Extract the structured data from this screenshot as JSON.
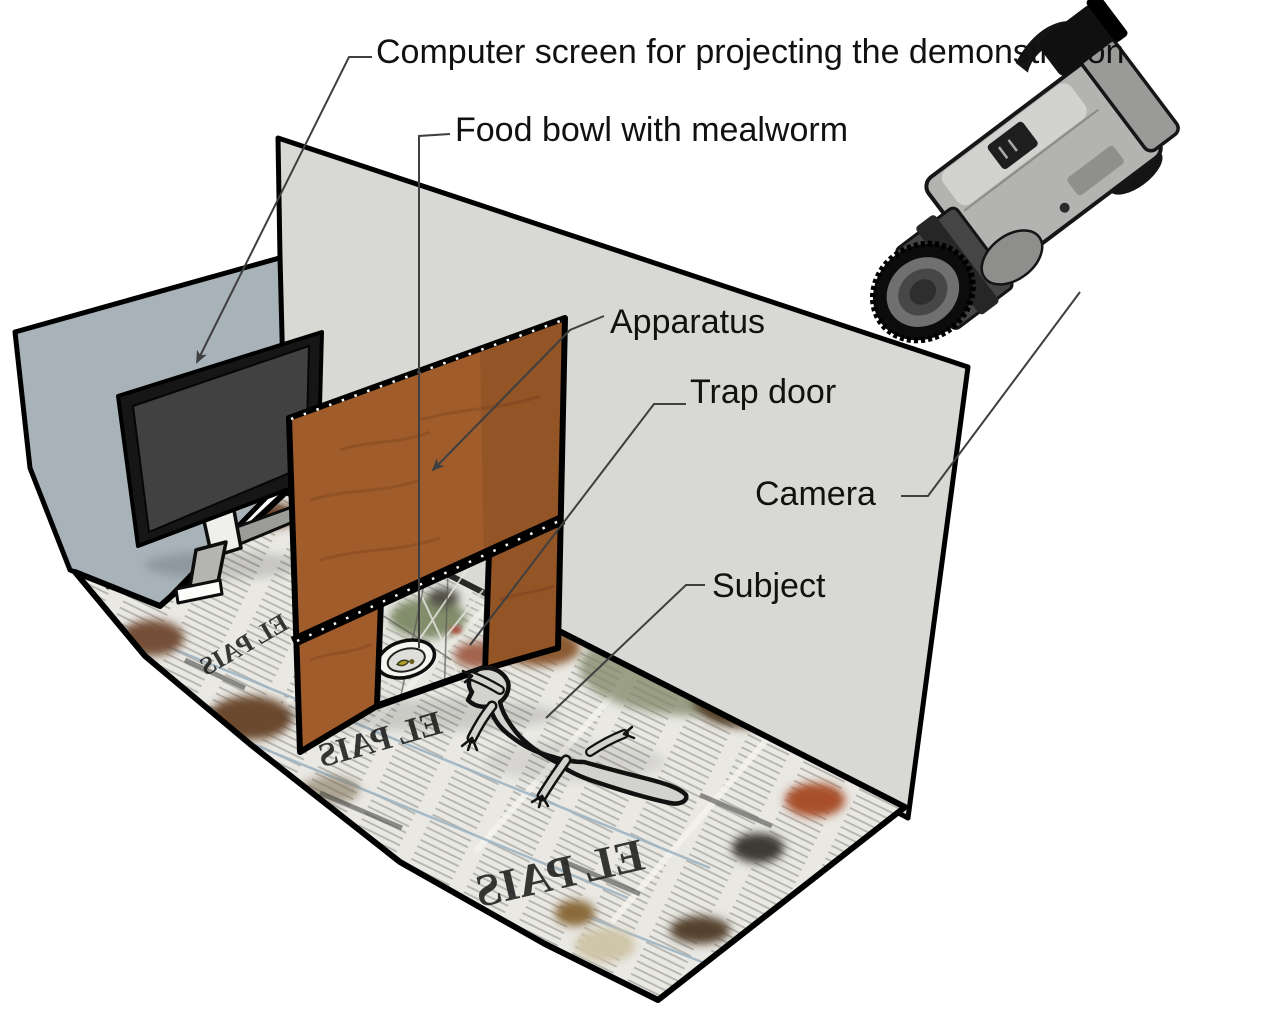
{
  "figure": {
    "kind": "experimental-setup-diagram",
    "labels": {
      "computer_screen": "Computer screen for projecting the demonstration",
      "food_bowl": "Food bowl with mealworm",
      "apparatus": "Apparatus",
      "trap_door": "Trap door",
      "camera": "Camera",
      "subject": "Subject"
    },
    "floor": {
      "newspaper_masthead": "EL PAIS"
    },
    "colors": {
      "background": "#ffffff",
      "left_wall": "#a7b2b9",
      "back_wall": "#d8d8d4",
      "apparatus_wood": "#a05c2a",
      "floor_newsprint": "#e9e8e3",
      "monitor_screen": "#414141",
      "outline": "#000000",
      "label_text": "#111111",
      "leader_line": "#3f3f3f"
    }
  }
}
